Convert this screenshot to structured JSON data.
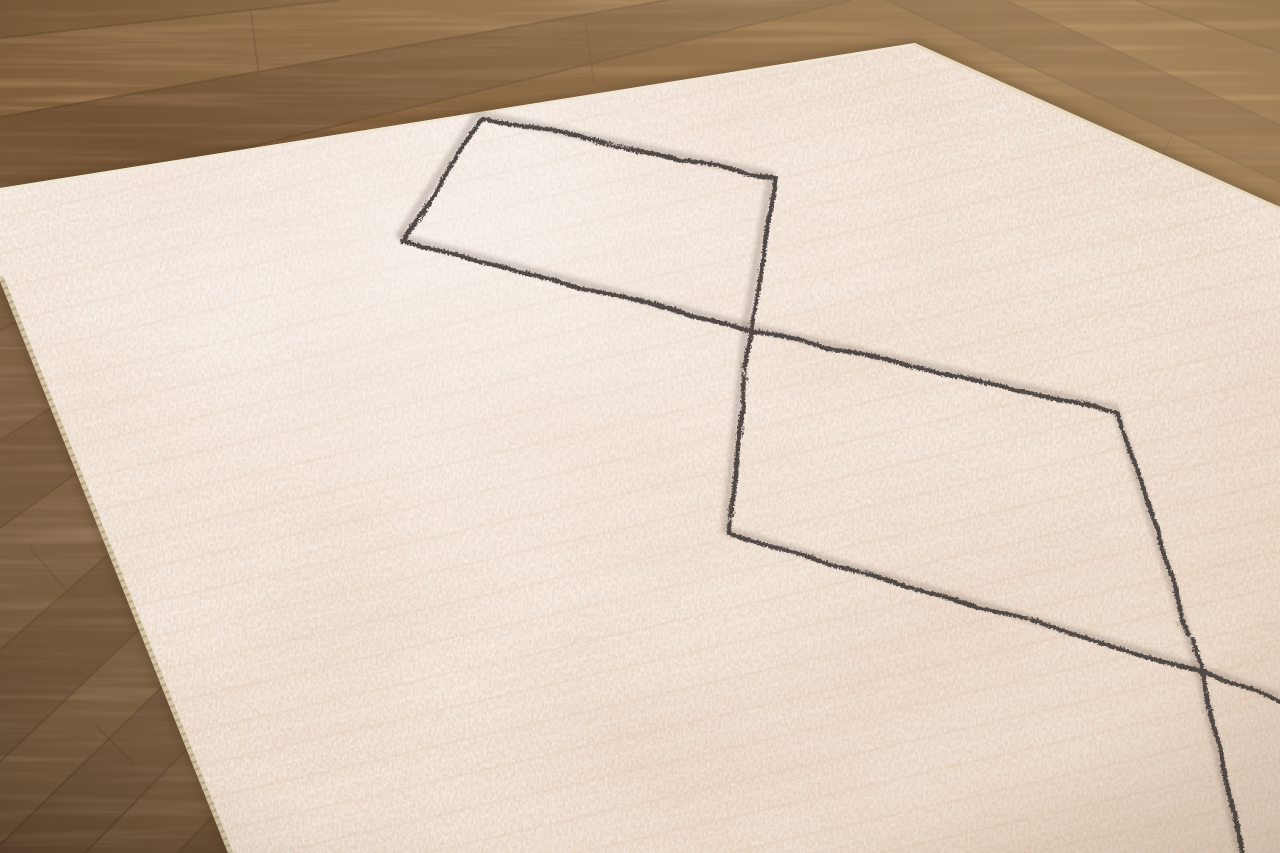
{
  "scene": {
    "canvas": {
      "width": 1280,
      "height": 853
    },
    "wood": {
      "base_top_color": "#a37a52",
      "base_bottom_color": "#7e6044",
      "grain_color": "#53381f",
      "seam_color": "#5e4227",
      "seam_opacity": "0.5",
      "joint_color": "#64482c",
      "light_patch_color": "#c4a582",
      "planks": [
        {
          "points": "0,0 340,0 0,38",
          "color": "#9b744e"
        },
        {
          "points": "340,0 667,0 0,117 0,38",
          "color": "#b0875e"
        },
        {
          "points": "667,0 852,0 233,151 0,188 0,117",
          "color": "#8f6c4a"
        },
        {
          "points": "852,0 886,0 1280,182 1280,207 915,43 233,151",
          "color": "#a0764c"
        },
        {
          "points": "886,0 1005,0 1280,125 1280,182",
          "color": "#8c6440"
        },
        {
          "points": "1005,0 1135,0 1280,52 1280,125",
          "color": "#a87c50"
        },
        {
          "points": "1135,0 1280,0 1280,52",
          "color": "#9d7348"
        },
        {
          "points": "0,281 0,330 16,322",
          "color": "#8f7253"
        },
        {
          "points": "0,330 0,440 51,408 16,322",
          "color": "#9a7a5c"
        },
        {
          "points": "0,440 0,528 77,473 51,408",
          "color": "#8a6b50"
        },
        {
          "points": "0,528 0,650 109,554 77,473",
          "color": "#a08060"
        },
        {
          "points": "0,650 0,762 139,630 109,554",
          "color": "#8d6e52"
        },
        {
          "points": "0,762 0,845 162,687 139,630",
          "color": "#a98866"
        },
        {
          "points": "0,845 0,853 85,853 187,749 162,687",
          "color": "#917057"
        },
        {
          "points": "85,853 178,853 213,816 187,749",
          "color": "#a07e5e"
        },
        {
          "points": "178,853 228,853 213,816",
          "color": "#8b6b50"
        }
      ],
      "seams": [
        "0,38 340,0",
        "0,117 667,0",
        "233,151 852,0",
        "0,330 16,322",
        "0,440 51,408",
        "0,528 77,473",
        "0,650 109,554",
        "0,762 139,630",
        "0,845 162,687",
        "85,853 187,749",
        "178,853 213,816",
        "886,0 1280,182",
        "1005,0 1280,125",
        "1135,0 1280,52"
      ],
      "joints": [
        "251,12 259,76",
        "585,20 594,84",
        "1172,135 1160,160",
        "30,548 66,590",
        "96,726 134,764"
      ]
    },
    "rug": {
      "outline": "0,188 915,43 1280,207 1280,853 228,853 0,281",
      "field_color": "#f4e9df",
      "mottle_color": "#e9cfba",
      "speckle_light_color": "#ffffff",
      "speckle_dark_color": "#d8bda6",
      "shadow_color": "#4e3822",
      "shadow_path": "M0,188 L915,43 L1280,207 M228,853 L0,281",
      "binding_left": {
        "path": "M0,281 L228,853",
        "color": "#d3c5a6",
        "stitch_color": "#b5a27f"
      },
      "binding_top": {
        "path": "M0,188 L915,43",
        "color": "#efe7d6"
      },
      "binding_right": {
        "path": "M915,43 L1280,207",
        "color": "#e5d9c0"
      }
    },
    "motif": {
      "stitch_color": "#514844",
      "underlay_color": "#6e5f57",
      "stroke_width": "4.3",
      "path_a": "M399,237 L746,326 L1115,408 L1198,668 L1240,853",
      "path_b": "M399,237 L478,114 L771,175 L746,326 L725,530 L1198,668 L1280,697"
    }
  }
}
